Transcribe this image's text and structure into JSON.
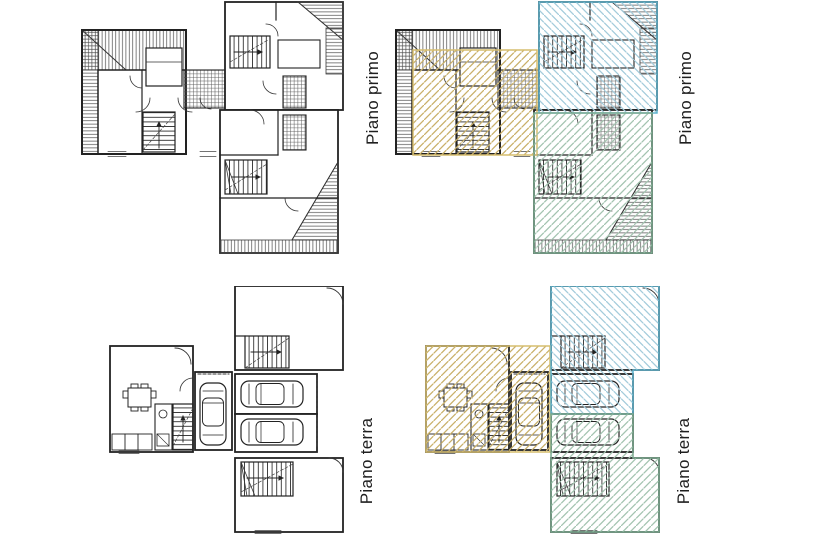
{
  "sheet": {
    "background": "#ffffff",
    "ink": "#222222",
    "description_labels": {
      "first_floor": "Piano primo",
      "ground_floor": "Piano terra"
    }
  },
  "panels": {
    "primo_plain": {
      "label": "Piano primo"
    },
    "primo_colored": {
      "label": "Piano primo"
    },
    "terra_plain": {
      "label": "Piano terra"
    },
    "terra_colored": {
      "label": "Piano terra"
    }
  },
  "units": {
    "unit_a": {
      "hatch": "#c9b069",
      "border": "#d6bd6e"
    },
    "unit_b": {
      "hatch": "#a3cbdb",
      "border": "#5fb3cd"
    },
    "unit_c": {
      "hatch": "#a3c3b0",
      "border": "#7cab90"
    }
  }
}
